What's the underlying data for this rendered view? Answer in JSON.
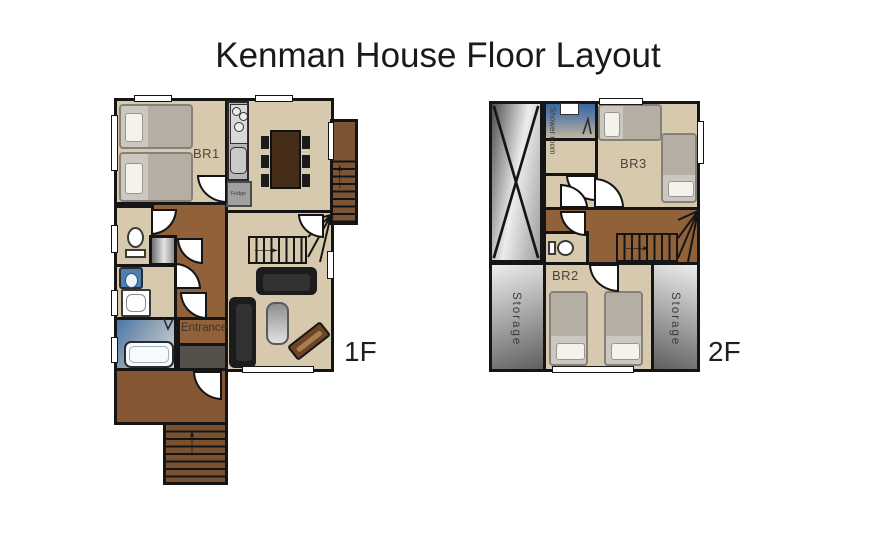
{
  "title": "Kenman House Floor Layout",
  "floor1": {
    "label": "1F",
    "br1": "BR1",
    "fridge": "Fridge",
    "entrance": "Entrance"
  },
  "floor2": {
    "label": "2F",
    "shower_room": "Shower room",
    "br3": "BR3",
    "br2": "BR2",
    "storage_left": "Storage",
    "storage_right": "Storage"
  },
  "icons": {
    "arrow_up": "↑",
    "arrow_right": "→"
  },
  "colors": {
    "wall": "#151515",
    "floor_beige": "#d7c9ad",
    "floor_brown": "#91613a",
    "water_blue": "#3a67a3",
    "dining_table_brown": "#462d1a"
  }
}
